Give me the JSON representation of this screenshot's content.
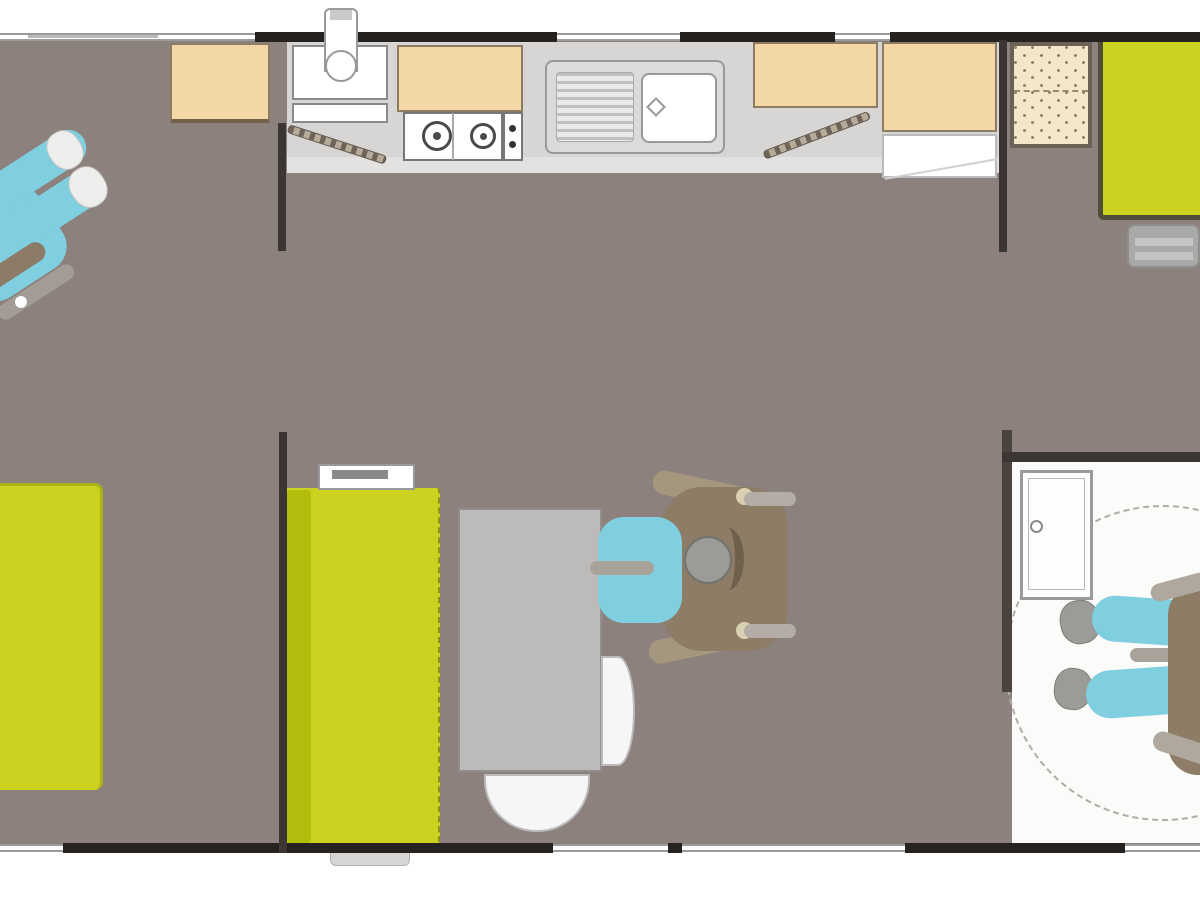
{
  "meta": {
    "description": "accessible mobile-home floor plan, top-down view, no visible text"
  },
  "palette": {
    "floor": "#8c817c",
    "wall": "#26221f",
    "interior_wall": "#3b3533",
    "furniture_green": "#cbd21f",
    "green_dark": "#9aa314",
    "green_stripe": "#b2bd0e",
    "cabinet_beige": "#f4d7a6",
    "beige_border": "#8c7c62",
    "counter_gray": "#d7d6d4",
    "appliance_white": "#ffffff",
    "person_blue": "#7fcfe0",
    "wheelchair_brown": "#8d7c66",
    "table_gray": "#bcbbb9",
    "bath_floor": "#fbfbfa"
  },
  "elements": [
    {
      "name": "floor-main",
      "x": 0,
      "y": 38,
      "w": 1200,
      "h": 810,
      "z": 1,
      "css": "background:#8c817c"
    },
    {
      "name": "bathroom-floor",
      "x": 1012,
      "y": 462,
      "w": 188,
      "h": 381,
      "z": 2,
      "css": "background:#fbfbfa"
    },
    {
      "name": "kitchen-counter",
      "x": 287,
      "y": 42,
      "w": 712,
      "h": 131,
      "z": 3,
      "css": "background:#d7d6d4"
    },
    {
      "name": "kitchen-counter-edge",
      "x": 287,
      "y": 157,
      "w": 712,
      "h": 16,
      "z": 3,
      "css": "background:#e3e2e0"
    },
    {
      "name": "turning-circle",
      "x": 1005,
      "y": 505,
      "w": 316,
      "h": 316,
      "z": 3,
      "css": "border:2px dashed #b3aba5;border-radius:50%"
    },
    {
      "name": "entry-cabinet",
      "x": 292,
      "y": 45,
      "w": 96,
      "h": 55,
      "z": 4,
      "css": "background:#ffffff;border:2px solid #8a8a8a"
    },
    {
      "name": "entry-shelf",
      "x": 292,
      "y": 103,
      "w": 96,
      "h": 20,
      "z": 4,
      "css": "background:#ffffff;border:2px solid #8a8a8a"
    },
    {
      "name": "wall-cabinet-over-stove",
      "x": 397,
      "y": 45,
      "w": 126,
      "h": 67,
      "z": 4,
      "css": "background:#f4d7a6;border:2px solid #8c7c62"
    },
    {
      "name": "stove-body",
      "x": 403,
      "y": 112,
      "w": 100,
      "h": 49,
      "z": 4,
      "css": "background:#ffffff;border:2px solid #777777"
    },
    {
      "name": "stove-divider",
      "x": 452,
      "y": 113,
      "w": 2,
      "h": 47,
      "z": 4,
      "css": "background:#aaaaaa"
    },
    {
      "name": "stove-burner-left",
      "x": 422,
      "y": 121,
      "w": 30,
      "h": 30,
      "z": 4,
      "css": "border:3px solid #4a4a4a;border-radius:50%;background:#ffffff"
    },
    {
      "name": "stove-burner-left-center",
      "x": 433,
      "y": 132,
      "w": 8,
      "h": 8,
      "z": 4,
      "css": "background:#4a4a4a;border-radius:50%"
    },
    {
      "name": "stove-burner-right",
      "x": 470,
      "y": 123,
      "w": 26,
      "h": 26,
      "z": 4,
      "css": "border:3px solid #4a4a4a;border-radius:50%;background:#ffffff"
    },
    {
      "name": "stove-burner-right-center",
      "x": 480,
      "y": 133,
      "w": 7,
      "h": 7,
      "z": 4,
      "css": "background:#4a4a4a;border-radius:50%"
    },
    {
      "name": "stove-knob-panel",
      "x": 503,
      "y": 112,
      "w": 20,
      "h": 49,
      "z": 4,
      "css": "background:#ffffff;border:2px solid #777777"
    },
    {
      "name": "stove-knob-top",
      "x": 509,
      "y": 125,
      "w": 7,
      "h": 7,
      "z": 4,
      "css": "background:#333333;border-radius:50%"
    },
    {
      "name": "stove-knob-bottom",
      "x": 509,
      "y": 141,
      "w": 7,
      "h": 7,
      "z": 4,
      "css": "background:#333333;border-radius:50%"
    },
    {
      "name": "kitchen-sink-unit",
      "x": 545,
      "y": 60,
      "w": 180,
      "h": 94,
      "z": 4,
      "css": "background:#dcdbd9;border:2px solid #999999;border-radius:8px"
    },
    {
      "name": "kitchen-sink-drainer",
      "x": 556,
      "y": 72,
      "w": 78,
      "h": 70,
      "z": 4,
      "cls": "ribs",
      "css": "border:1px solid #aaaaaa;border-radius:4px"
    },
    {
      "name": "kitchen-sink-basin",
      "x": 641,
      "y": 73,
      "w": 76,
      "h": 70,
      "z": 4,
      "css": "background:#ffffff;border:2px solid #999999;border-radius:8px"
    },
    {
      "name": "kitchen-sink-drain",
      "x": 649,
      "y": 100,
      "w": 14,
      "h": 14,
      "z": 4,
      "r": 45,
      "css": "background:#ffffff;border:2px solid #999999"
    },
    {
      "name": "cabinet-right-of-sink",
      "x": 753,
      "y": 42,
      "w": 125,
      "h": 66,
      "z": 4,
      "css": "background:#f4d7a6;border:2px solid #8c7c62"
    },
    {
      "name": "tall-cabinet-fridge",
      "x": 882,
      "y": 42,
      "w": 115,
      "h": 90,
      "z": 4,
      "css": "background:#f4d7a6;border:2px solid #8c7c62"
    },
    {
      "name": "fridge-open-shelf",
      "x": 882,
      "y": 134,
      "w": 115,
      "h": 44,
      "z": 4,
      "css": "background:#ffffff;border:2px solid #bbbbbb"
    },
    {
      "name": "fridge-shelf-line",
      "x": 884,
      "y": 168,
      "w": 114,
      "h": 2,
      "z": 4,
      "r": -10,
      "css": "background:#d0d0ce"
    },
    {
      "name": "wardrobe-dotted",
      "x": 1010,
      "y": 42,
      "w": 82,
      "h": 106,
      "z": 4,
      "cls": "dots",
      "css": "border:4px solid #6b6157"
    },
    {
      "name": "wardrobe-hanging-rail",
      "x": 1014,
      "y": 90,
      "w": 74,
      "h": 3,
      "z": 4,
      "css": "border-top:2px dashed #9a8a6a"
    },
    {
      "name": "bed-right-bedroom",
      "x": 1098,
      "y": 42,
      "w": 102,
      "h": 178,
      "z": 4,
      "css": "background:#cbd21f;border-left:5px solid #4f4c3a;border-bottom:5px solid #4f4c3a;border-radius:0 0 0 6px"
    },
    {
      "name": "bed-steps",
      "x": 1127,
      "y": 224,
      "w": 73,
      "h": 44,
      "z": 4,
      "css": "background:#a9a9a7;border:2px solid #8f8f8d;border-radius:8px"
    },
    {
      "name": "bed-steps-bar-top",
      "x": 1135,
      "y": 238,
      "w": 58,
      "h": 8,
      "z": 4,
      "css": "background:#c4c4c2"
    },
    {
      "name": "bed-steps-bar-bottom",
      "x": 1135,
      "y": 252,
      "w": 58,
      "h": 8,
      "z": 4,
      "css": "background:#c4c4c2"
    },
    {
      "name": "wardrobe-left-bedroom",
      "x": 170,
      "y": 43,
      "w": 100,
      "h": 80,
      "z": 4,
      "css": "background:#f4d7a6;border:2px solid #8c7c62;border-bottom:4px solid #70604a"
    },
    {
      "name": "bed-left-bedroom",
      "x": 0,
      "y": 483,
      "w": 103,
      "h": 307,
      "z": 4,
      "css": "background:#cbd21f;border-top:3px solid #aab215;border-right:3px solid #aab215;border-radius:0 8px 8px 0"
    },
    {
      "name": "sofa",
      "x": 285,
      "y": 488,
      "w": 155,
      "h": 357,
      "z": 4,
      "css": "background:#cbd21f;border-right:2px dashed #8b9112;border-radius:3px"
    },
    {
      "name": "sofa-back-stripe",
      "x": 287,
      "y": 490,
      "w": 24,
      "h": 353,
      "z": 4,
      "css": "background:#b2bd0e;border-radius:3px"
    },
    {
      "name": "sofa-wall-shelf",
      "x": 318,
      "y": 464,
      "w": 97,
      "h": 26,
      "z": 5,
      "css": "background:#ffffff;border:2px solid #999999"
    },
    {
      "name": "sofa-wall-shelf-bar",
      "x": 332,
      "y": 470,
      "w": 56,
      "h": 9,
      "z": 5,
      "css": "background:#8a8a8a"
    },
    {
      "name": "dining-table",
      "x": 458,
      "y": 508,
      "w": 144,
      "h": 264,
      "z": 4,
      "css": "background:#bcbbb9;border:2px solid #908f8d"
    },
    {
      "name": "dining-bench-bottom",
      "x": 484,
      "y": 774,
      "w": 106,
      "h": 58,
      "z": 4,
      "css": "background:#f6f6f6;border:2px solid #bbbbbb;border-radius:0 0 52px 52px"
    },
    {
      "name": "dining-chair-right",
      "x": 601,
      "y": 656,
      "w": 34,
      "h": 110,
      "z": 4,
      "css": "background:#f6f6f6;border:2px solid #bbbbbb;border-radius:0 50% 50% 0"
    },
    {
      "name": "shower-tray",
      "x": 1020,
      "y": 470,
      "w": 73,
      "h": 130,
      "z": 4,
      "css": "background:#fdfdfd;border:3px solid #9a9a98"
    },
    {
      "name": "shower-tray-inner",
      "x": 1028,
      "y": 478,
      "w": 57,
      "h": 112,
      "z": 4,
      "css": "border:1px solid #b8b8b6"
    },
    {
      "name": "shower-drain",
      "x": 1030,
      "y": 520,
      "w": 13,
      "h": 13,
      "z": 4,
      "css": "background:#ffffff;border:2px solid #8a8a88;border-radius:50%"
    },
    {
      "name": "entry-step-outside",
      "x": 330,
      "y": 851,
      "w": 80,
      "h": 15,
      "z": 5,
      "css": "background:#d6d6d6;border:1px solid #b0b0b0;border-radius:0 0 6px 6px"
    },
    {
      "name": "open-door-left",
      "x": 288,
      "y": 124,
      "w": 103,
      "h": 9,
      "z": 5,
      "r": 18,
      "o": "0 50%",
      "cls": "hatch"
    },
    {
      "name": "open-door-right",
      "x": 764,
      "y": 151,
      "w": 113,
      "h": 9,
      "z": 5,
      "r": -21,
      "o": "0 50%",
      "cls": "hatch"
    },
    {
      "name": "top-window-left",
      "x": 0,
      "y": 33,
      "w": 255,
      "h": 8,
      "z": 6,
      "cls": "window"
    },
    {
      "name": "top-window-left-mark",
      "x": 28,
      "y": 35,
      "w": 130,
      "h": 3,
      "z": 6,
      "css": "background:#b9b9b7"
    },
    {
      "name": "top-wall-1",
      "x": 255,
      "y": 32,
      "w": 302,
      "h": 10,
      "z": 6,
      "css": "background:#26221f"
    },
    {
      "name": "top-window-sink",
      "x": 557,
      "y": 33,
      "w": 123,
      "h": 8,
      "z": 6,
      "cls": "window"
    },
    {
      "name": "top-wall-2",
      "x": 680,
      "y": 32,
      "w": 155,
      "h": 10,
      "z": 6,
      "css": "background:#26221f"
    },
    {
      "name": "top-window-right",
      "x": 835,
      "y": 33,
      "w": 55,
      "h": 8,
      "z": 6,
      "cls": "window"
    },
    {
      "name": "top-wall-3",
      "x": 890,
      "y": 32,
      "w": 310,
      "h": 10,
      "z": 6,
      "css": "background:#26221f"
    },
    {
      "name": "bottom-window-left",
      "x": 0,
      "y": 844,
      "w": 63,
      "h": 8,
      "z": 6,
      "cls": "window"
    },
    {
      "name": "bottom-wall-1",
      "x": 63,
      "y": 843,
      "w": 490,
      "h": 10,
      "z": 6,
      "css": "background:#26221f"
    },
    {
      "name": "bottom-window-dining",
      "x": 553,
      "y": 844,
      "w": 115,
      "h": 8,
      "z": 6,
      "cls": "window"
    },
    {
      "name": "bottom-wall-post",
      "x": 668,
      "y": 843,
      "w": 14,
      "h": 10,
      "z": 6,
      "css": "background:#26221f"
    },
    {
      "name": "bottom-sliding-door",
      "x": 682,
      "y": 844,
      "w": 223,
      "h": 8,
      "z": 6,
      "cls": "window"
    },
    {
      "name": "bottom-wall-2",
      "x": 905,
      "y": 843,
      "w": 220,
      "h": 10,
      "z": 6,
      "css": "background:#26221f"
    },
    {
      "name": "bottom-window-bath",
      "x": 1125,
      "y": 844,
      "w": 75,
      "h": 8,
      "z": 6,
      "cls": "window"
    },
    {
      "name": "interior-wall-left-top",
      "x": 278,
      "y": 123,
      "w": 8,
      "h": 128,
      "z": 6,
      "css": "background:#3b3533"
    },
    {
      "name": "interior-wall-left-bottom",
      "x": 279,
      "y": 432,
      "w": 8,
      "h": 421,
      "z": 6,
      "css": "background:#3b3533"
    },
    {
      "name": "interior-wall-right-top",
      "x": 999,
      "y": 40,
      "w": 8,
      "h": 212,
      "z": 6,
      "css": "background:#3b3533"
    },
    {
      "name": "interior-wall-bath-left",
      "x": 1002,
      "y": 430,
      "w": 10,
      "h": 262,
      "z": 6,
      "css": "background:#4a443f"
    },
    {
      "name": "bathroom-top-wall",
      "x": 1002,
      "y": 452,
      "w": 198,
      "h": 10,
      "z": 6,
      "css": "background:#3b3533"
    },
    {
      "name": "water-heater-body",
      "x": 324,
      "y": 8,
      "w": 34,
      "h": 64,
      "z": 7,
      "css": "background:#ffffff;border:2px solid #9a9a9a;border-radius:6px 6px 0 0"
    },
    {
      "name": "water-heater-cap",
      "x": 330,
      "y": 10,
      "w": 22,
      "h": 10,
      "z": 7,
      "css": "background:#c9c9c9"
    },
    {
      "name": "water-heater-drum",
      "x": 325,
      "y": 50,
      "w": 32,
      "h": 32,
      "z": 7,
      "css": "background:#ffffff;border:2px solid #9a9a9a;border-radius:50%"
    },
    {
      "name": "wheelchair-user-left-body",
      "x": -45,
      "y": 198,
      "w": 105,
      "h": 92,
      "z": 8,
      "r": -33,
      "css": "background:#7fcfe0;border-radius:26px"
    },
    {
      "name": "wheelchair-user-left-leg-1",
      "x": -38,
      "y": 156,
      "w": 132,
      "h": 36,
      "z": 8,
      "r": -33,
      "css": "background:#7fcfe0;border-radius:18px"
    },
    {
      "name": "wheelchair-user-left-leg-2",
      "x": -30,
      "y": 200,
      "w": 136,
      "h": 38,
      "z": 8,
      "r": -33,
      "css": "background:#7fcfe0;border-radius:19px"
    },
    {
      "name": "wheelchair-user-left-shoe-1",
      "x": 48,
      "y": 130,
      "w": 34,
      "h": 40,
      "z": 8,
      "r": -33,
      "css": "background:#eeeeec;border:1px solid #c6c6c4;border-radius:45%"
    },
    {
      "name": "wheelchair-user-left-shoe-2",
      "x": 70,
      "y": 166,
      "w": 36,
      "h": 42,
      "z": 8,
      "r": -33,
      "css": "background:#eeeeec;border:1px solid #c6c6c4;border-radius:45%"
    },
    {
      "name": "wheelchair-user-left-wheel",
      "x": -28,
      "y": 258,
      "w": 78,
      "h": 20,
      "z": 8,
      "r": -33,
      "css": "background:#8b7b67;border-radius:10px"
    },
    {
      "name": "wheelchair-user-left-frame",
      "x": -8,
      "y": 284,
      "w": 88,
      "h": 16,
      "z": 8,
      "r": -33,
      "css": "background:#a29c94;border-radius:8px"
    },
    {
      "name": "wheelchair-user-left-footrest",
      "x": 14,
      "y": 295,
      "w": 14,
      "h": 14,
      "z": 8,
      "css": "background:#ffffff;border:1px solid #999999;border-radius:50%"
    },
    {
      "name": "wheelchair-dining-wheel-arc-top",
      "x": 652,
      "y": 478,
      "w": 95,
      "h": 24,
      "z": 8,
      "r": 12,
      "css": "background:#a5967e;border-radius:12px"
    },
    {
      "name": "wheelchair-dining-wheel-arc-bottom",
      "x": 648,
      "y": 632,
      "w": 98,
      "h": 24,
      "z": 8,
      "r": -12,
      "css": "background:#a5967e;border-radius:12px"
    },
    {
      "name": "wheelchair-dining-frame",
      "x": 662,
      "y": 487,
      "w": 126,
      "h": 164,
      "z": 8,
      "css": "background:#8d7c66;border-radius:40px"
    },
    {
      "name": "wheelchair-dining-handle-knob-top",
      "x": 736,
      "y": 488,
      "w": 17,
      "h": 17,
      "z": 8,
      "css": "background:#d9d0b2;border-radius:50%"
    },
    {
      "name": "wheelchair-dining-handle-top",
      "x": 744,
      "y": 492,
      "w": 52,
      "h": 14,
      "z": 8,
      "css": "background:#b3ada5;border-radius:7px"
    },
    {
      "name": "wheelchair-dining-handle-knob-bottom",
      "x": 736,
      "y": 622,
      "w": 17,
      "h": 17,
      "z": 8,
      "css": "background:#d9d0b2;border-radius:50%"
    },
    {
      "name": "wheelchair-dining-handle-bottom",
      "x": 744,
      "y": 624,
      "w": 52,
      "h": 14,
      "z": 8,
      "css": "background:#b3ada5;border-radius:7px"
    },
    {
      "name": "wheelchair-user-dining-torso",
      "x": 598,
      "y": 517,
      "w": 84,
      "h": 106,
      "z": 8,
      "css": "background:#7fcfe0;border-radius:26px"
    },
    {
      "name": "wheelchair-user-dining-armrest",
      "x": 590,
      "y": 561,
      "w": 64,
      "h": 14,
      "z": 8,
      "css": "background:#a8a29b;border-radius:7px"
    },
    {
      "name": "wheelchair-user-dining-head",
      "x": 684,
      "y": 536,
      "w": 48,
      "h": 48,
      "z": 8,
      "css": "background:#9b9b97;border:2px solid #73736e;border-radius:50%"
    },
    {
      "name": "wheelchair-user-dining-headrest",
      "x": 712,
      "y": 528,
      "w": 32,
      "h": 62,
      "z": 8,
      "css": "border-right:9px solid #6f604c;border-radius:50%"
    },
    {
      "name": "wheelchair-user-bath-shoe-1",
      "x": 1060,
      "y": 600,
      "w": 40,
      "h": 44,
      "z": 8,
      "r": -10,
      "css": "background:#9b9b97;border:1px solid #7d7d79;border-radius:45%"
    },
    {
      "name": "wheelchair-user-bath-shoe-2",
      "x": 1054,
      "y": 668,
      "w": 38,
      "h": 42,
      "z": 8,
      "r": 8,
      "css": "background:#9b9b97;border:1px solid #7d7d79;border-radius:45%"
    },
    {
      "name": "wheelchair-user-bath-leg-1",
      "x": 1092,
      "y": 598,
      "w": 112,
      "h": 46,
      "z": 8,
      "r": 4,
      "css": "background:#7fcfe0;border-radius:23px"
    },
    {
      "name": "wheelchair-user-bath-leg-2",
      "x": 1086,
      "y": 668,
      "w": 114,
      "h": 48,
      "z": 8,
      "r": -4,
      "css": "background:#7fcfe0;border-radius:24px"
    },
    {
      "name": "wheelchair-user-bath-armrest",
      "x": 1130,
      "y": 648,
      "w": 62,
      "h": 14,
      "z": 8,
      "css": "background:#a8a29b;border-radius:7px"
    },
    {
      "name": "wheelchair-user-bath-body",
      "x": 1168,
      "y": 585,
      "w": 62,
      "h": 190,
      "z": 8,
      "css": "background:#8d7c66;border-radius:30px"
    },
    {
      "name": "wheelchair-user-bath-frame-top",
      "x": 1150,
      "y": 578,
      "w": 60,
      "h": 18,
      "z": 8,
      "r": -15,
      "css": "background:#b0a89e;border-radius:9px"
    },
    {
      "name": "wheelchair-user-bath-wheel",
      "x": 1152,
      "y": 738,
      "w": 62,
      "h": 20,
      "z": 8,
      "r": 18,
      "css": "background:#b0a89e;border-radius:10px"
    }
  ]
}
